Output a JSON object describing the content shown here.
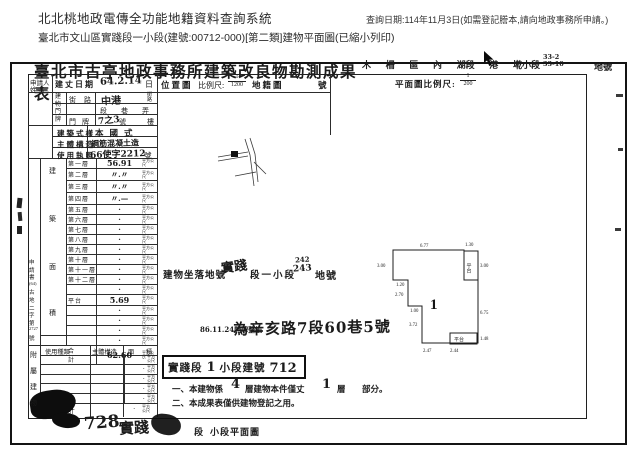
{
  "page": {
    "system_title": "北北桃地政電傳全功能地籍資料查詢系統",
    "query_date_note": "查詢日期:114年11月3日(如需登記謄本,請向地政事務所申請。)",
    "subtitle": "臺北市文山區實踐段一小段(建號:00712-000)[第二類]建物平面圖(已縮小列印)"
  },
  "colors": {
    "ink": "#1b1b1b",
    "paper": "#ffffff"
  },
  "icons": {
    "cursor": "mouse-pointer-arrow"
  },
  "form": {
    "title": "臺北市古亭地政事務所建築改良物勘測成果表",
    "district": {
      "parts": [
        "木",
        "柵",
        "區",
        "內",
        "湖段",
        "港",
        "墘小段"
      ],
      "lot_hand_1": "33-2",
      "lot_hand_2": "33-10",
      "suffix": "地號"
    },
    "row1": {
      "applicant_l1": "申請人",
      "applicant_l2": "姓 名",
      "survey_label": "建丈日期",
      "survey_value": "64.2.14",
      "survey_suffix": "日",
      "locmap_label": "位置圖",
      "scale_label": "比例尺:",
      "scale_num": "1",
      "scale_den": "1200",
      "cadastral_label": "地籍圖",
      "cadastral_suffix": "號",
      "plan_scale_label": "平面圖比例尺:",
      "plan_scale_num": "1",
      "plan_scale_den": "200"
    },
    "address": {
      "block_label": "建物門牌",
      "street_label": "街路",
      "street_value": "中港",
      "street_suffix": "街路",
      "sec_label": "段",
      "lane_label": "巷",
      "alley_label": "弄",
      "door_label": "門牌",
      "door_value": "7之3",
      "door_suffix": "號",
      "door_suffix2": "樓"
    },
    "style_label": "建築式樣",
    "style_value": "本國式",
    "structure_label": "主體構造",
    "structure_value": "鋼筋混凝土造",
    "license_label": "使用執照",
    "license_value": "66使字2212",
    "license_suffix": "號",
    "area": {
      "side_label": "建築面積",
      "unit": "平方公尺",
      "rows": [
        {
          "label": "第一層",
          "value": "56.91"
        },
        {
          "label": "第二層",
          "value": "〃.〃"
        },
        {
          "label": "第三層",
          "value": "〃.〃"
        },
        {
          "label": "第四層",
          "value": "〃.—"
        },
        {
          "label": "第五層",
          "value": "·"
        },
        {
          "label": "第六層",
          "value": "·"
        },
        {
          "label": "第七層",
          "value": "·"
        },
        {
          "label": "第八層",
          "value": "·"
        },
        {
          "label": "第九層",
          "value": "·"
        },
        {
          "label": "第十層",
          "value": "·"
        },
        {
          "label": "第十一層",
          "value": "·"
        },
        {
          "label": "第十二層",
          "value": "·"
        },
        {
          "label": "",
          "value": "·"
        },
        {
          "label": "平台",
          "value": "5.69"
        },
        {
          "label": "",
          "value": "·"
        },
        {
          "label": "",
          "value": "·"
        },
        {
          "label": "",
          "value": "·"
        },
        {
          "label": "",
          "value": "·"
        },
        {
          "label": "合 計",
          "value": "62.60"
        }
      ]
    },
    "application_no_lines": [
      "申",
      "請",
      "書",
      "(64)",
      "古",
      "地",
      "二",
      "字",
      "第",
      "2727",
      "號"
    ],
    "annex": {
      "side_label": "附屬建物",
      "col1": "使用種類",
      "col2": "主體構造",
      "col3_a": "面",
      "col3_b": "積",
      "rows": [
        "·",
        "·",
        "·",
        "·",
        "·"
      ],
      "total_label": "合 計",
      "total_value": "·",
      "unit": "平方公尺"
    },
    "site": {
      "prefix": "建物坐落地號",
      "hand_seg": "實踐",
      "mid": "段一小段",
      "hand_alt": "242",
      "hand_lot": "243",
      "suffix": "地號"
    },
    "renumber": {
      "small_text": "86.11.24門牌整編",
      "hand_text": "為辛亥路7段60巷5號"
    },
    "stamp_box": {
      "seg": "實踐段",
      "hand_no": "1",
      "mid": "小段建號",
      "hand_bno": "712"
    },
    "notes": {
      "n1_a": "一、本建物係",
      "n1_hand1": "4",
      "n1_b": "層建物本件僅丈",
      "n1_hand2": "1",
      "n1_c": "層",
      "n1_d": "部分。",
      "n2": "二、本成果表僅供建物登記之用。"
    },
    "plan": {
      "building_label": "1",
      "platform1_label": "平台",
      "platform2_label": "平台",
      "dims": [
        {
          "t": "6.77",
          "x": 50,
          "y": 21
        },
        {
          "t": "1.30",
          "x": 95,
          "y": 20
        },
        {
          "t": "3.00",
          "x": 7,
          "y": 41
        },
        {
          "t": "1.20",
          "x": 26,
          "y": 60
        },
        {
          "t": "2.70",
          "x": 25,
          "y": 70
        },
        {
          "t": "1.00",
          "x": 40,
          "y": 86
        },
        {
          "t": "3.72",
          "x": 39,
          "y": 100
        },
        {
          "t": "3.00",
          "x": 110,
          "y": 41
        },
        {
          "t": "6.75",
          "x": 110,
          "y": 88
        },
        {
          "t": "1.48",
          "x": 110,
          "y": 114
        },
        {
          "t": "2.47",
          "x": 53,
          "y": 126
        },
        {
          "t": "2.44",
          "x": 80,
          "y": 126
        }
      ]
    },
    "bottom": {
      "hand_no": "728",
      "hand_seg": "實踐",
      "printed1": "段",
      "printed2": "小段平面圖"
    }
  }
}
